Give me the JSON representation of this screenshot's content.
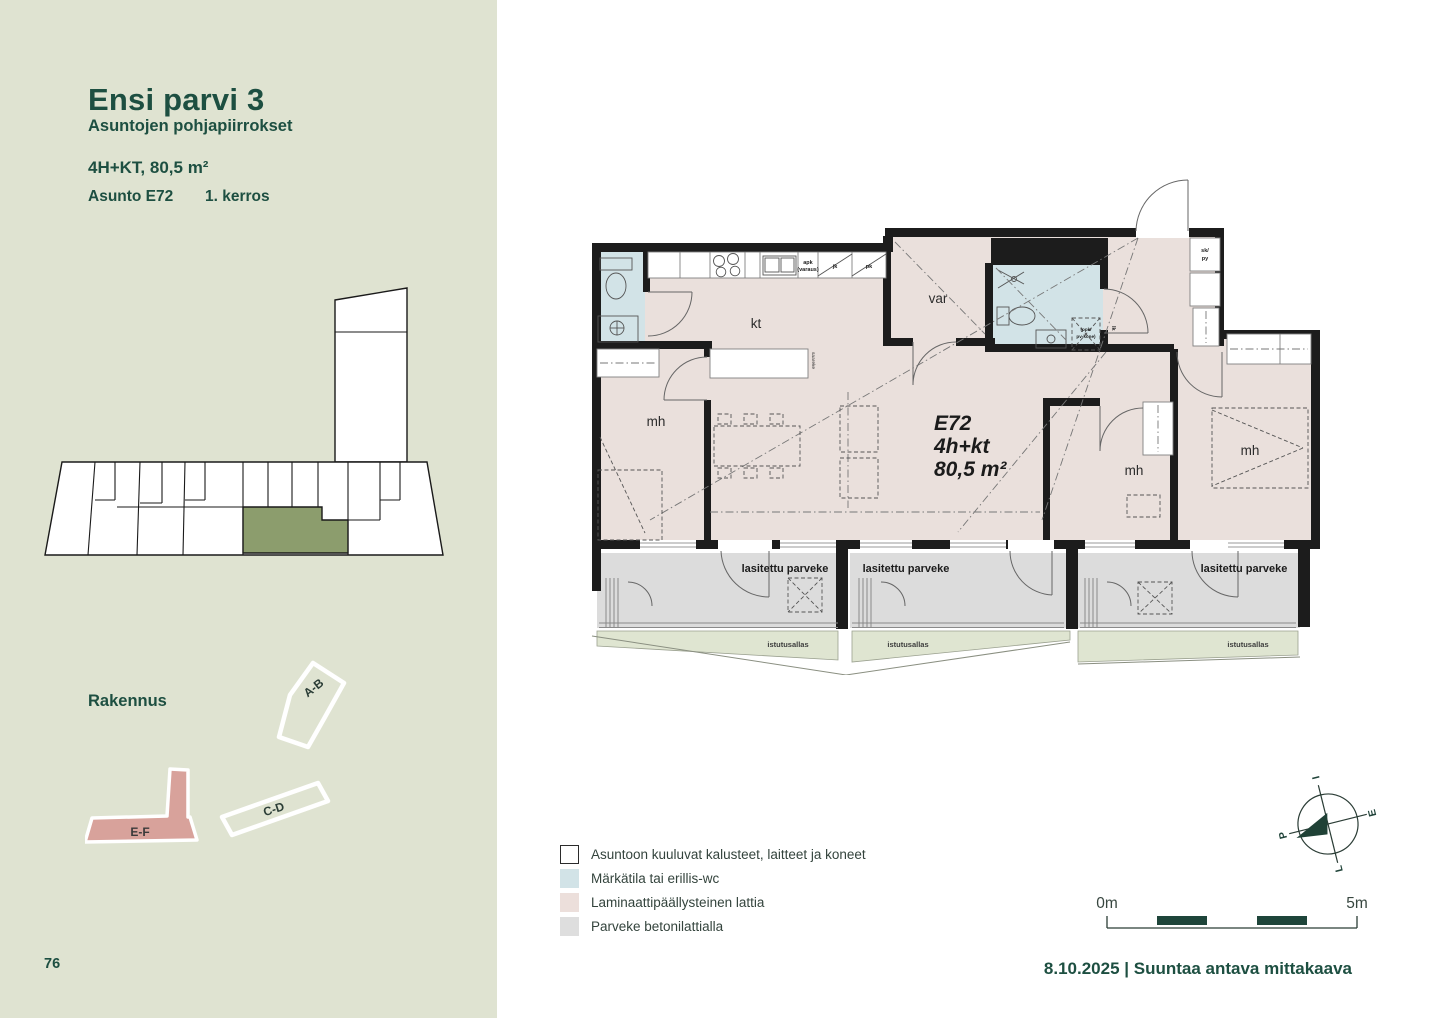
{
  "sidebar": {
    "title": "Ensi parvi 3",
    "subtitle": "Asuntojen pohjapiirrokset",
    "spec": "4H+KT, 80,5 m²",
    "unit": "Asunto E72",
    "floor": "1. kerros",
    "building_heading": "Rakennus",
    "buildings": {
      "ab": "A-B",
      "cd": "C-D",
      "ef": "E-F"
    },
    "page_number": "76"
  },
  "plan": {
    "unit_id": "E72",
    "unit_type": "4h+kt",
    "unit_area": "80,5 m²",
    "rooms": {
      "kitchen": "kt",
      "storage": "var",
      "bedroom": "mh"
    },
    "balcony": "lasitettu parveke",
    "planter": "istutusallas",
    "labels": {
      "closet1": "sk/",
      "closet2": "py",
      "apk1": "apk",
      "apk2": "(varaus)",
      "fridge": "jk",
      "freezer": "pk",
      "washer1": "(ppk/",
      "washer2": "pv-kone)",
      "lk": "lk",
      "island": "saareke"
    }
  },
  "legend": {
    "items": [
      {
        "label": "Asuntoon kuuluvat kalusteet, laitteet ja koneet",
        "swatch": "#ffffff",
        "border": "#2b2b2b"
      },
      {
        "label": "Märkätila tai erillis-wc",
        "swatch": "#d2e3e7",
        "border": "transparent"
      },
      {
        "label": "Laminaattipäällysteinen lattia",
        "swatch": "#ecdfdb",
        "border": "transparent"
      },
      {
        "label": "Parveke betonilattialla",
        "swatch": "#dedede",
        "border": "transparent"
      }
    ]
  },
  "compass": {
    "top": "I",
    "right": "E",
    "bottom": "L",
    "left": "P"
  },
  "scalebar": {
    "start": "0m",
    "end": "5m"
  },
  "footer": {
    "dateline": "8.10.2025 | Suuntaa antava mittakaava"
  },
  "colors": {
    "accent_green": "#1d4f41",
    "highlight_unit": "#8c9d6d",
    "building_ef": "#d8a29b",
    "wet_room": "#d2e3e7",
    "laminate": "#eae0dc",
    "balcony_floor": "#dcdcdc",
    "planter_green": "#dfe5d1",
    "scalebar_green": "#1e453a"
  }
}
